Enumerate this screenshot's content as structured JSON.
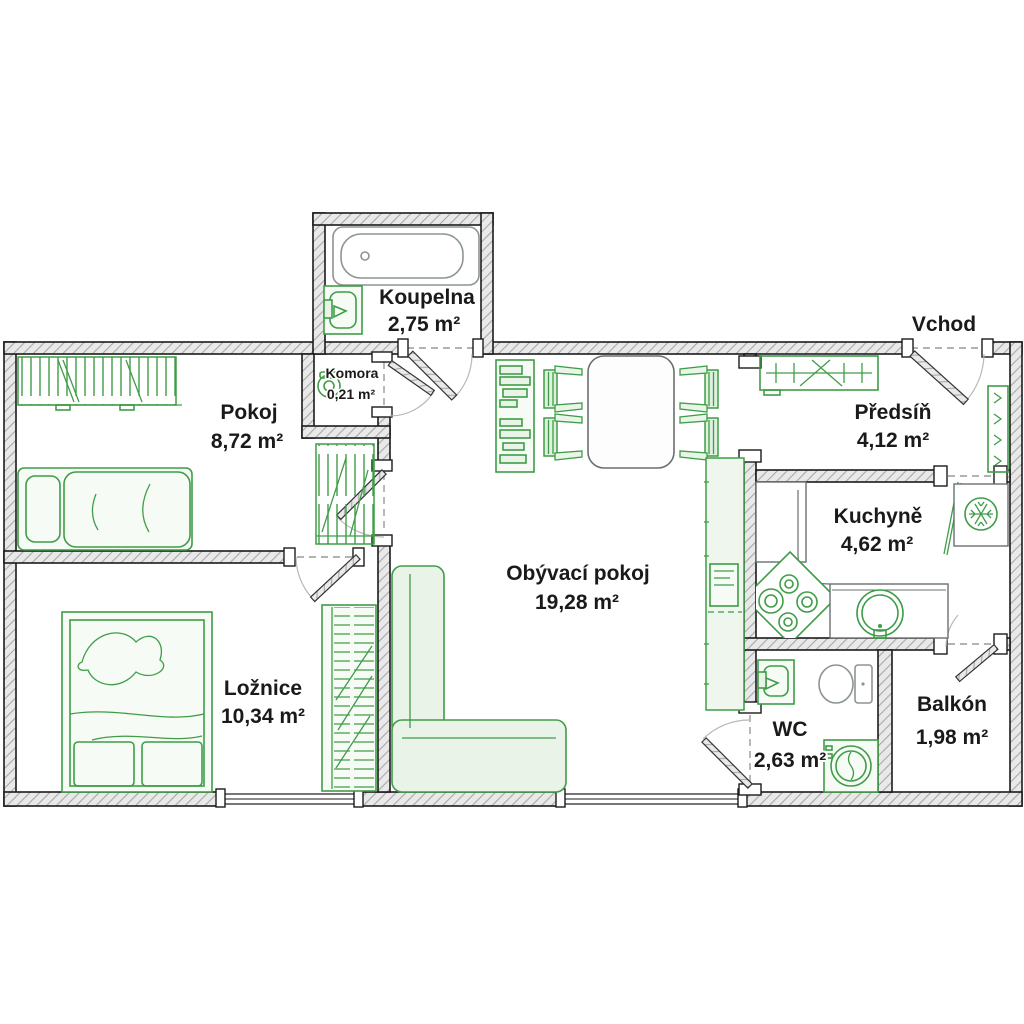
{
  "plan": {
    "entrance_label": "Vchod",
    "rooms": [
      {
        "id": "koupelna",
        "name": "Koupelna",
        "area": "2,75 m²"
      },
      {
        "id": "komora",
        "name": "Komora",
        "area": "0,21 m²"
      },
      {
        "id": "pokoj",
        "name": "Pokoj",
        "area": "8,72 m²"
      },
      {
        "id": "loznice",
        "name": "Ložnice",
        "area": "10,34 m²"
      },
      {
        "id": "obyvaci-pokoj",
        "name": "Obývací pokoj",
        "area": "19,28 m²"
      },
      {
        "id": "predsin",
        "name": "Předsíň",
        "area": "4,12 m²"
      },
      {
        "id": "kuchyne",
        "name": "Kuchyně",
        "area": "4,62 m²"
      },
      {
        "id": "wc",
        "name": "WC",
        "area": "2,63 m²"
      },
      {
        "id": "balkon",
        "name": "Balkón",
        "area": "1,98 m²"
      }
    ],
    "colors": {
      "furniture_green": "#3f9d47",
      "furniture_fill": "#e9f3e8",
      "wall_fill": "#e9e9e9",
      "wall_hatch": "#a8a8a8",
      "outline": "#1b1b1b",
      "fixture_gray": "#8d9494",
      "label_text": "#1a1a1a"
    }
  }
}
